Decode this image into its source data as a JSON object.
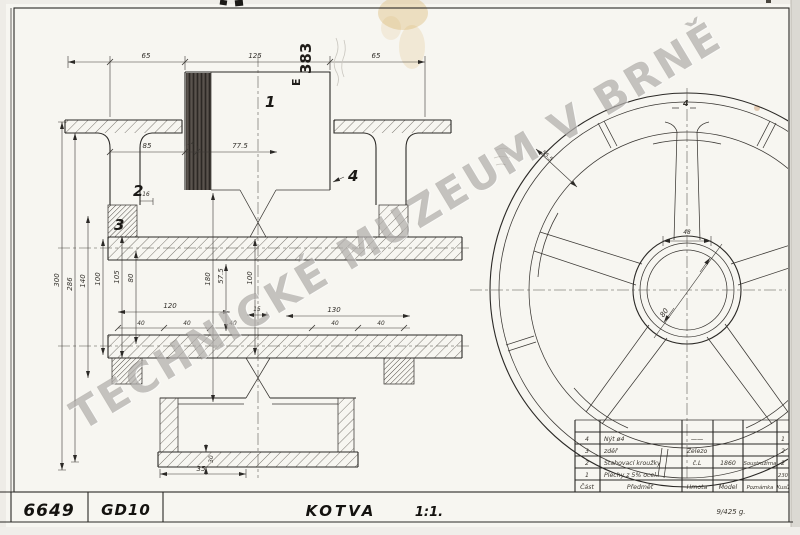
{
  "watermark": {
    "text": "TECHNICKÉ MUZEUM V BRNĚ"
  },
  "title_block": {
    "number": "6649",
    "code": "GD10",
    "name": "KOTVA",
    "scale": "1:1.",
    "stamp": "9/425 g."
  },
  "notes": {
    "rotated": "383",
    "rotated_letter": "E"
  },
  "part_labels": {
    "p1": "1",
    "p2": "2",
    "p3": "3",
    "p4": "4",
    "p4_circle": "4"
  },
  "dims": {
    "top": [
      "65",
      "125",
      "65"
    ],
    "mid": [
      "85",
      "14",
      "77.5",
      "16"
    ],
    "vert": [
      "300",
      "286",
      "140",
      "100",
      "105",
      "80",
      "180",
      "57.5",
      "100"
    ],
    "width_row": [
      "120",
      "15",
      "130"
    ],
    "forty": [
      "40",
      "40",
      "40",
      "40",
      "40"
    ],
    "flange": [
      "35",
      "30"
    ],
    "circle": {
      "rim": "55.5",
      "spoke_hub": "48",
      "bore": "80"
    }
  },
  "parts_table": {
    "headers": {
      "item": "Část",
      "subject": "Předmět",
      "material": "Hmota",
      "model": "Model",
      "note": "Poznámka",
      "qty": "Kusů"
    },
    "rows": [
      {
        "item": "4",
        "subject": "Nýt ø4",
        "material": "——",
        "model": "",
        "note": "",
        "qty": "1"
      },
      {
        "item": "3",
        "subject": "zděř",
        "material": "Železo",
        "model": "",
        "note": "",
        "qty": "2"
      },
      {
        "item": "2",
        "subject": "Stahovací kroužky",
        "material": "č.L",
        "model": "1860",
        "note": "Soustružírna",
        "qty": "2"
      },
      {
        "item": "1",
        "subject": "Plechy z 5% ocel.",
        "material": "",
        "model": "",
        "note": "",
        "qty": "230"
      }
    ]
  },
  "colors": {
    "ink": "#2b2926",
    "paper": "#f7f6f1",
    "stain": "#d7aa5a",
    "watermark": "#767370"
  }
}
